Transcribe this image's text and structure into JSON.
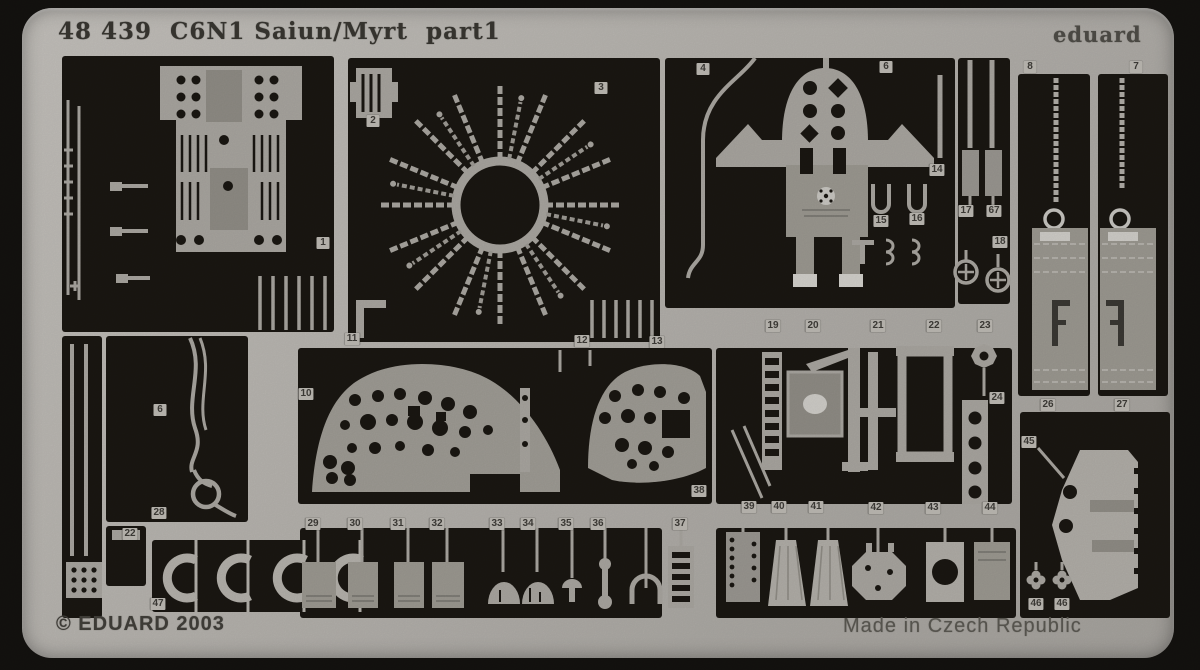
{
  "photo": {
    "title": "48 439  C6N1 Saiun/Myrt  part1",
    "brand": "eduard",
    "copyright": "© EDUARD 2003",
    "made_in": "Made in Czech Republic",
    "subject": "photo-etched metal detail fret for aircraft model",
    "colors": {
      "sheet_metal": "#b6b3ae",
      "photo_background": "#14120f",
      "cutout_black": "#1a1712",
      "part_grey": "#a8a59f",
      "pad_grey": "#8f8c85",
      "highlight": "#d2d0cb"
    },
    "part_labels": [
      {
        "n": "1",
        "x": 323,
        "y": 243
      },
      {
        "n": "2",
        "x": 373,
        "y": 121
      },
      {
        "n": "3",
        "x": 601,
        "y": 88
      },
      {
        "n": "4",
        "x": 703,
        "y": 69
      },
      {
        "n": "6",
        "x": 886,
        "y": 67
      },
      {
        "n": "8",
        "x": 1030,
        "y": 67
      },
      {
        "n": "7",
        "x": 1136,
        "y": 67
      },
      {
        "n": "14",
        "x": 937,
        "y": 170
      },
      {
        "n": "15",
        "x": 881,
        "y": 221
      },
      {
        "n": "16",
        "x": 917,
        "y": 219
      },
      {
        "n": "17",
        "x": 966,
        "y": 211
      },
      {
        "n": "67",
        "x": 994,
        "y": 211
      },
      {
        "n": "18",
        "x": 1000,
        "y": 242
      },
      {
        "n": "10",
        "x": 306,
        "y": 394
      },
      {
        "n": "11",
        "x": 352,
        "y": 339
      },
      {
        "n": "12",
        "x": 582,
        "y": 341
      },
      {
        "n": "13",
        "x": 657,
        "y": 342
      },
      {
        "n": "19",
        "x": 773,
        "y": 326
      },
      {
        "n": "20",
        "x": 813,
        "y": 326
      },
      {
        "n": "21",
        "x": 878,
        "y": 326
      },
      {
        "n": "22",
        "x": 934,
        "y": 326
      },
      {
        "n": "23",
        "x": 985,
        "y": 326
      },
      {
        "n": "24",
        "x": 997,
        "y": 398
      },
      {
        "n": "6",
        "x": 160,
        "y": 410
      },
      {
        "n": "28",
        "x": 159,
        "y": 513
      },
      {
        "n": "22",
        "x": 130,
        "y": 534
      },
      {
        "n": "47",
        "x": 158,
        "y": 604
      },
      {
        "n": "38",
        "x": 699,
        "y": 491
      },
      {
        "n": "29",
        "x": 313,
        "y": 524
      },
      {
        "n": "30",
        "x": 355,
        "y": 524
      },
      {
        "n": "31",
        "x": 398,
        "y": 524
      },
      {
        "n": "32",
        "x": 437,
        "y": 524
      },
      {
        "n": "33",
        "x": 497,
        "y": 524
      },
      {
        "n": "34",
        "x": 528,
        "y": 524
      },
      {
        "n": "35",
        "x": 566,
        "y": 524
      },
      {
        "n": "36",
        "x": 598,
        "y": 524
      },
      {
        "n": "37",
        "x": 680,
        "y": 524
      },
      {
        "n": "39",
        "x": 749,
        "y": 507
      },
      {
        "n": "40",
        "x": 779,
        "y": 507
      },
      {
        "n": "41",
        "x": 816,
        "y": 507
      },
      {
        "n": "42",
        "x": 876,
        "y": 508
      },
      {
        "n": "43",
        "x": 933,
        "y": 508
      },
      {
        "n": "44",
        "x": 990,
        "y": 508
      },
      {
        "n": "26",
        "x": 1048,
        "y": 405
      },
      {
        "n": "27",
        "x": 1122,
        "y": 405
      },
      {
        "n": "45",
        "x": 1029,
        "y": 442
      },
      {
        "n": "46",
        "x": 1036,
        "y": 604
      },
      {
        "n": "46",
        "x": 1062,
        "y": 604
      }
    ]
  }
}
